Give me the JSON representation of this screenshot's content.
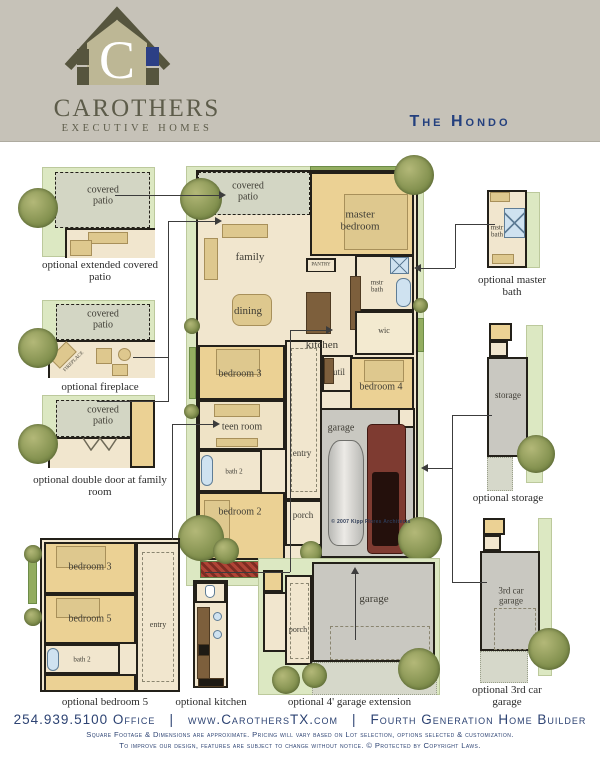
{
  "header": {
    "brand": "CAROTHERS",
    "brand_sub": "EXECUTIVE HOMES",
    "logo_letter": "C",
    "title": "The Hondo"
  },
  "colors": {
    "accent_navy": "#24407e",
    "roof_olive": "#56553e",
    "logo_blue": "#2c3f85",
    "bedroom_gold": "#ebd194",
    "lawn_green": "#dce8c2"
  },
  "plan": {
    "covered_patio": "covered patio",
    "master_bedroom": "master bedroom",
    "family": "family",
    "dining": "dining",
    "kitchen": "kitchen",
    "pantry": "pantry",
    "mstr_bath": "mstr bath",
    "wic": "wic",
    "util": "util",
    "bedroom3": "bedroom 3",
    "bedroom4": "bedroom 4",
    "teen_room": "teen room",
    "bath2": "bath 2",
    "entry": "entry",
    "garage": "garage",
    "bedroom2": "bedroom 2",
    "porch": "porch",
    "copyright": "© 2007 Kipp Flores Architects"
  },
  "options": {
    "ext_patio": {
      "caption": "optional extended covered patio",
      "patio": "covered patio"
    },
    "fireplace": {
      "caption": "optional fireplace",
      "patio": "covered patio",
      "fireplace": "fireplace"
    },
    "double_door": {
      "caption": "optional double door at family room",
      "patio": "covered patio"
    },
    "bedroom5": {
      "caption": "optional bedroom 5",
      "bedroom3": "bedroom 3",
      "bedroom5": "bedroom 5",
      "bath2": "bath 2",
      "entry": "entry"
    },
    "master_bath": {
      "caption": "optional master bath",
      "label": "mstr bath"
    },
    "storage": {
      "caption": "optional storage",
      "label": "storage"
    },
    "third_car": {
      "caption": "optional 3rd car garage",
      "label": "3rd car garage"
    },
    "kitchen": {
      "caption": "optional kitchen"
    },
    "garage_ext": {
      "caption": "optional 4' garage extension",
      "garage": "garage",
      "porch": "porch"
    }
  },
  "footer": {
    "phone": "254.939.5100 Office",
    "separator": "|",
    "url": "www.CarothersTX.com",
    "tagline": "Fourth Generation Home Builder",
    "fine1": "Square Footage & Dimensions are approximate.  Pricing will vary based on Lot selection, options selected & customization.",
    "fine2": "To improve our design, features are subject to change without notice.  © Protected by Copyright Laws."
  }
}
